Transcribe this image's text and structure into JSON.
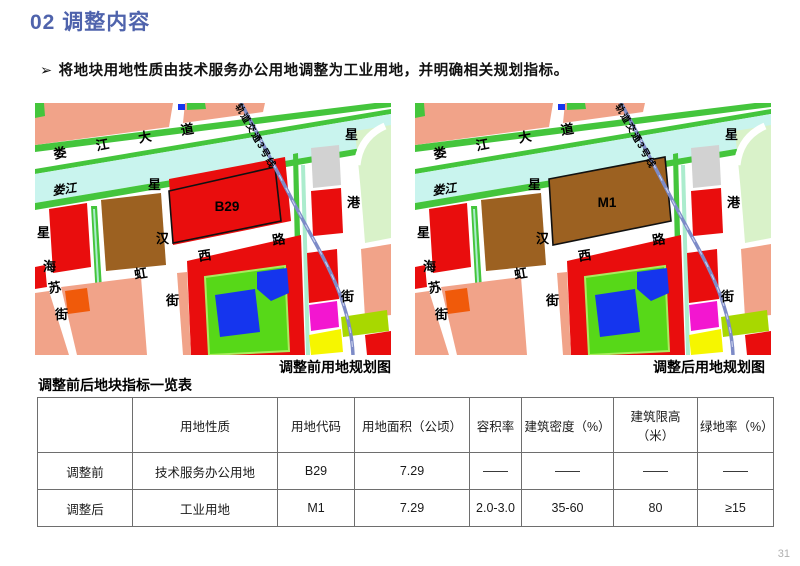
{
  "page": {
    "title": "02 调整内容",
    "bullet_marker": "➢",
    "bullet": "将地块用地性质由技术服务办公用地调整为工业用地，并明确相关规划指标。",
    "page_number": "31"
  },
  "maps": {
    "left": {
      "caption": "调整前用地规划图",
      "block_label": "B29",
      "block_fill": "red"
    },
    "right": {
      "caption": "调整后用地规划图",
      "block_label": "M1",
      "block_fill": "brown"
    },
    "labels": {
      "avenue": "娄江大道",
      "river": "娄江",
      "rail": "轨道交通3号线",
      "road_suhongxi": "苏虹西路",
      "street_xinghai": "星海街",
      "street_xinghan": "星汉街",
      "street_xinggang": "星港街"
    },
    "colors": {
      "red": "#e90d0d",
      "brown": "#9c6121",
      "salmon": "#f1a389",
      "stripGreen": "#44c53c",
      "paleGreen": "#d9f2c9",
      "brightGreen": "#57d818",
      "innerGreenBorder": "#aaeb5e",
      "blue": "#1535ee",
      "river": "#c9f4ee",
      "grey": "#d2d2d2",
      "orange": "#f05a0a",
      "magenta": "#f316d0",
      "yellow": "#f6f600",
      "yellowGreen": "#a8d800",
      "rail": "#7d8bc7",
      "railDash": "#ccd3ef",
      "median": "#abeccd",
      "riverText": "#27b4e4",
      "blockOutline": "#111111",
      "white": "#ffffff"
    }
  },
  "table": {
    "title": "调整前后地块指标一览表",
    "headers": [
      "",
      "用地性质",
      "用地代码",
      "用地面积（公顷）",
      "容积率",
      "建筑密度（%）",
      "建筑限高（米）",
      "绿地率（%）"
    ],
    "col_widths": [
      95,
      145,
      77,
      115,
      52,
      92,
      84,
      76
    ],
    "rows": [
      {
        "cells": [
          "调整前",
          "技术服务办公用地",
          "B29",
          "7.29",
          "——",
          "——",
          "——",
          "——"
        ]
      },
      {
        "cells": [
          "调整后",
          "工业用地",
          "M1",
          "7.29",
          "2.0-3.0",
          "35-60",
          "80",
          "≥15"
        ]
      }
    ]
  }
}
